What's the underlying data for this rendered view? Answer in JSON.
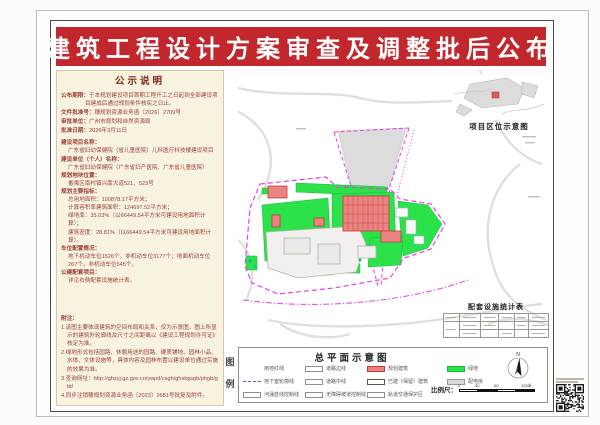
{
  "title": "建筑工程设计方案审查及调整批后公布",
  "notice": {
    "header": "公示说明",
    "l1_label": "公布期限：",
    "l1_v": "于本规划建设项目首期工程开工之日起到全部建设项目建成后通过规划条件核实之日止。",
    "l2_label": "文件批准号：",
    "l2_v": "穗规划资源业务函〔2026〕2709号",
    "l3_label": "审批单位：",
    "l3_v": "广州市规划和自然资源局",
    "l4_label": "批准日期：",
    "l4_v": "2026年3月11日",
    "info": {
      "p1_label": "建设项目名称：",
      "p1_v": "广东省妇幼保健院（省儿童医院）儿科医疗科技楼建设项目",
      "p2_label": "建设单位（个人）名称：",
      "p2_v": "广东省妇幼保健院（广东省妇产医院、广东省儿童医院）",
      "p3_label": "规划地块位置：",
      "p3_v": "番禺区南村镇兴南大道521、523号",
      "p4_label": "规划主要指标：",
      "p4_v1": "总用地面积：100878.17平方米；",
      "p4_v2": "计算容积率建筑面积：124697.52平方米；",
      "p4_v3": "绿地率：35.03%（以66449.54平方米可建设用地面积计算）；",
      "p4_v4": "建筑密度：28.81%（以66449.54平方米可建设用地面积计算）。",
      "p5_label": "车位配置情况：",
      "p5_v": "地下机动车位1526个，非机动车位3177个；地面机动车位267个，非机动车位545个。",
      "p6_label": "公建配套项目：",
      "p6_v": "详见右侧配套设施统计表。"
    },
    "notes_header": "附注：",
    "n1": "1.该图主要体现建筑的空间布局和关系，仅为示意图，图上所显示的建筑外轮廓线及尺寸之间距离以《建设工程规划许可证》核定为准。",
    "n2": "2.绿地形式包括园路、休憩用途的园路、硬质铺地、园林小品、水体、文体设施等，具体内容及园林布置以建设单位通过实施的效果为准。",
    "n3": "3.查询网址：http://ghzyj.gz.gov.cn/ywpd/csgh/ghxkgsgb/phgb/gbt/",
    "n4": "4.同步注销穗规划资源业务函〔2023〕2681号批复及附件。"
  },
  "insets": {
    "location_map_label": "项目区位示意图",
    "facilities_table_title": "配套设施统计表"
  },
  "plan": {
    "title": "总平面示意图",
    "legend_title_char1": "图",
    "legend_title_char2": "例",
    "compass_n": "N",
    "scale_label": "比例尺：",
    "scale_t0": "0",
    "scale_t1": "30",
    "scale_t2": "60",
    "scale_t3": "120米"
  },
  "legend_items": [
    {
      "label": "用地红线"
    },
    {
      "label": "道路边线"
    },
    {
      "label": "规划建筑"
    },
    {
      "label": "绿地"
    },
    {
      "label": "地下室轮廓线"
    },
    {
      "label": "道路中线"
    },
    {
      "label": "已建（保留）建筑"
    },
    {
      "label": "配电房"
    },
    {
      "label": "河涌蓝线控制线"
    },
    {
      "label": "无障碍坡道控制线"
    },
    {
      "label": "轨道交通保护区"
    }
  ],
  "colors": {
    "banner_red": "#c2272d",
    "panel_bg": "#f8f3df",
    "panel_text": "#9a4038",
    "boundary_magenta": "#e83ee8",
    "green_fill": "#2ce24a",
    "building_red": "#ec8383"
  }
}
